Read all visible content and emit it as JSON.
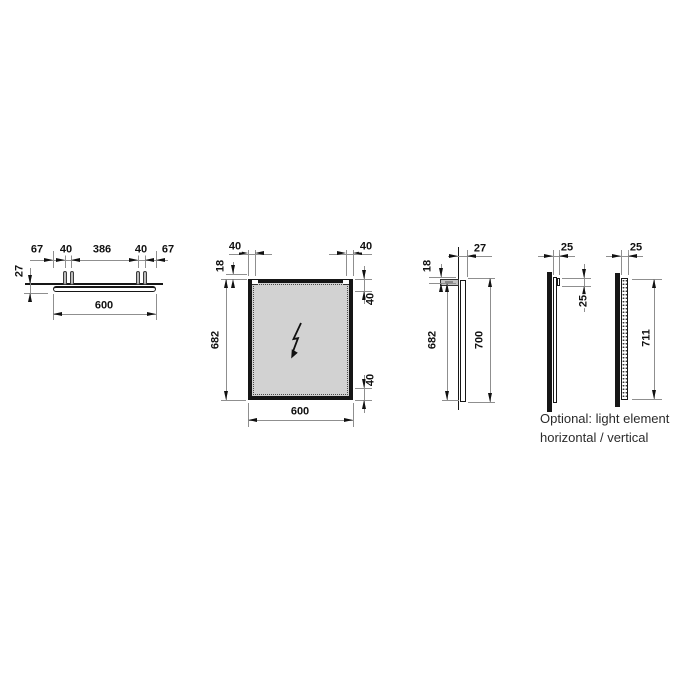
{
  "views": {
    "top_view": {
      "labels": {
        "edge_offset_left": "67",
        "hanger_pitch_left": "40",
        "hanger_span": "386",
        "hanger_pitch_right": "40",
        "edge_offset_right": "67",
        "depth": "27",
        "total_width": "600"
      }
    },
    "front_view": {
      "labels": {
        "hanger_inset_left": "40",
        "hanger_inset_right": "40",
        "hanger_above_top": "18",
        "height": "682",
        "top_edge_zone": "40",
        "bottom_edge_zone": "40",
        "width": "600"
      }
    },
    "side_view": {
      "labels": {
        "depth": "27",
        "hanger_above_top": "18",
        "height": "682",
        "total_height": "700"
      }
    },
    "optional_view": {
      "labels": {
        "depth_horizontal": "25",
        "light_element_height": "25",
        "depth_vertical": "25",
        "total_height": "711"
      },
      "caption_line1": "Optional: light element",
      "caption_line2": "horizontal / vertical"
    },
    "icons": {
      "power_symbol": "lightning-bolt"
    }
  },
  "colors": {
    "background": "#ffffff",
    "line": "#161616",
    "dim_line": "#8f8f8f",
    "mirror_fill": "#d2d2d2",
    "hardware_fill": "#bcbcbc"
  }
}
